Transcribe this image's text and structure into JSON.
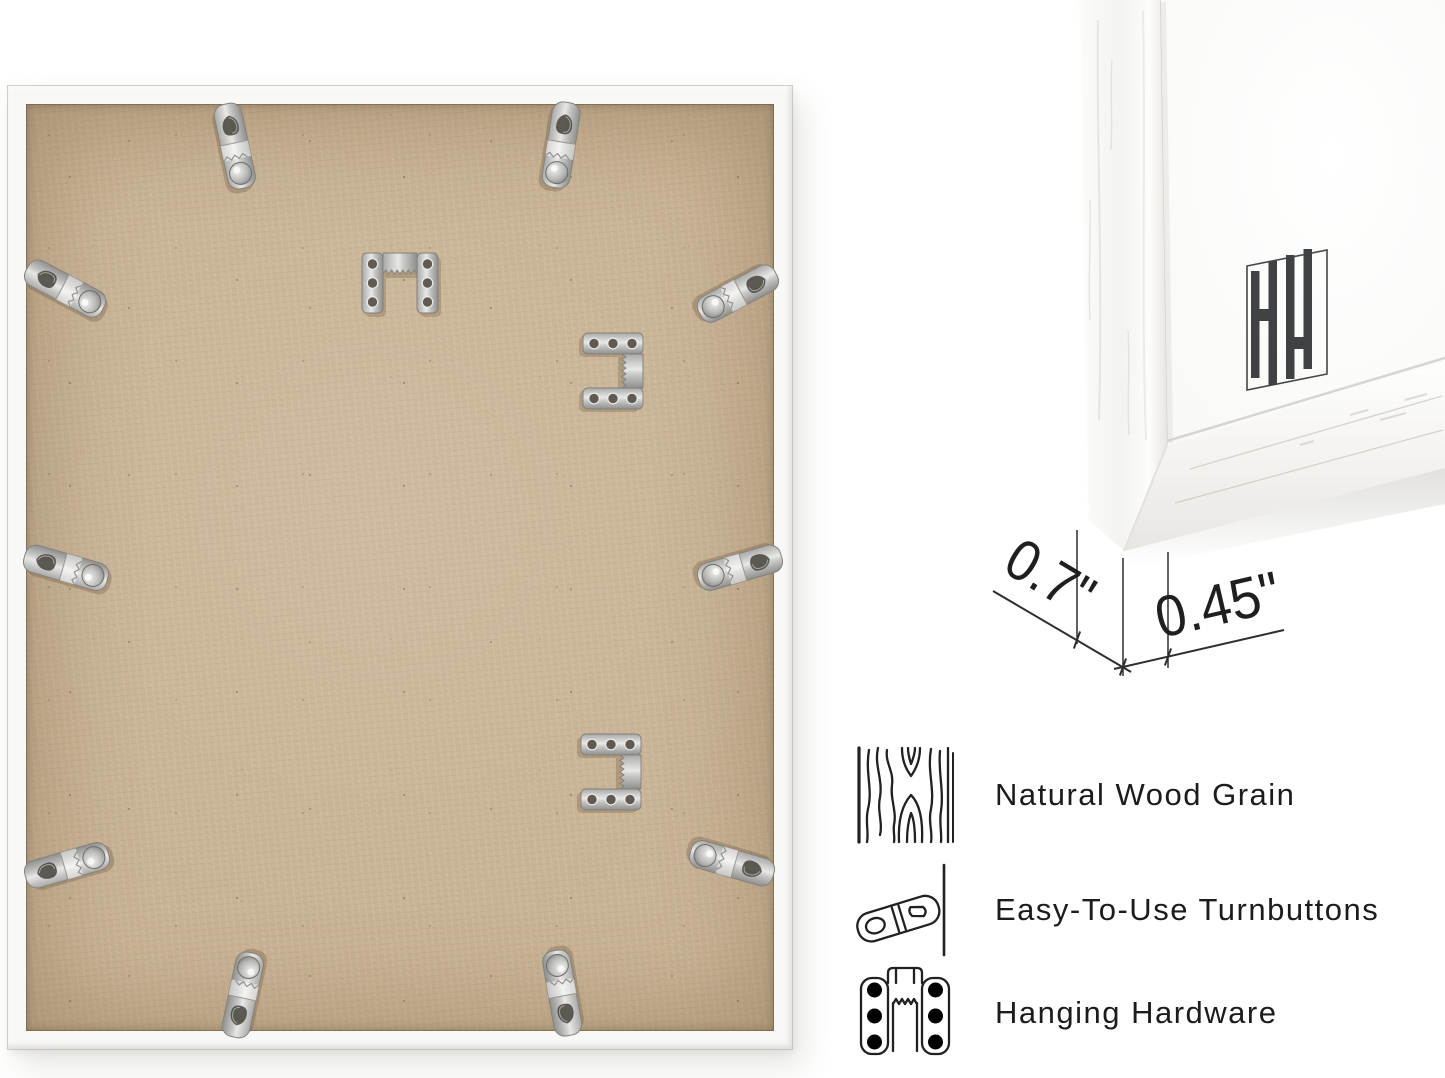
{
  "product": {
    "back_view": "picture frame back with mounting hardware",
    "corner_view": "white frame corner close-up",
    "logo": "hh-monogram"
  },
  "dimensions": {
    "depth": "0.7\"",
    "face_width": "0.45\""
  },
  "features": [
    {
      "icon": "wood-grain-icon",
      "label": "Natural Wood Grain"
    },
    {
      "icon": "turnbutton-icon",
      "label": "Easy-To-Use Turnbuttons"
    },
    {
      "icon": "hanging-hardware-icon",
      "label": "Hanging Hardware"
    }
  ],
  "hardware": {
    "turnbuttons": 10,
    "sawtooth_hangers": 3
  },
  "colors": {
    "background": "#ffffff",
    "frame_white": "#f8f8f6",
    "mdf_backing": "#c8b294",
    "annotation": "#2e2e2e",
    "logo": "#3f4143"
  }
}
